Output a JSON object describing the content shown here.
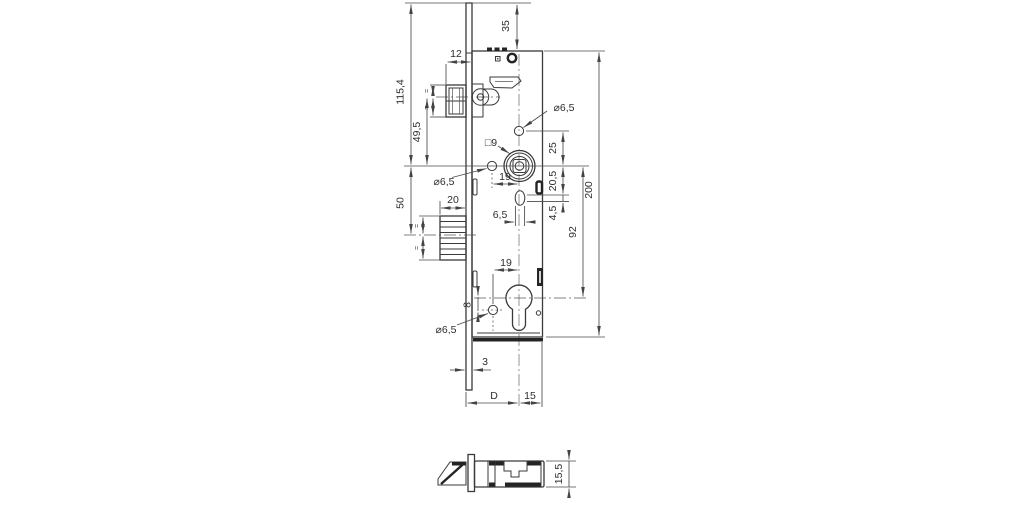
{
  "drawing": {
    "type": "technical-dimension-drawing",
    "subject": "mortise door lock case, side elevation with bottom section view",
    "colors": {
      "background": "#ffffff",
      "line": "#3a3a3a",
      "dimension": "#4a4a4a"
    }
  },
  "labels": {
    "d35": "35",
    "d12": "12",
    "d115_4": "115,4",
    "d49_5": "49,5",
    "d50": "50",
    "d20": "20",
    "dia_top": "⌀6,5",
    "dia_left": "⌀6,5",
    "dia_bottom": "⌀6,5",
    "sq9": "□9",
    "d25": "25",
    "d20_5": "20,5",
    "d4_5": "4,5",
    "d92": "92",
    "d200": "200",
    "d19_top": "19",
    "d6_5": "6,5",
    "d19_bottom": "19",
    "d8": "8",
    "d3": "3",
    "dD": "D",
    "d15": "15",
    "d15_5": "15,5",
    "eq": "="
  }
}
